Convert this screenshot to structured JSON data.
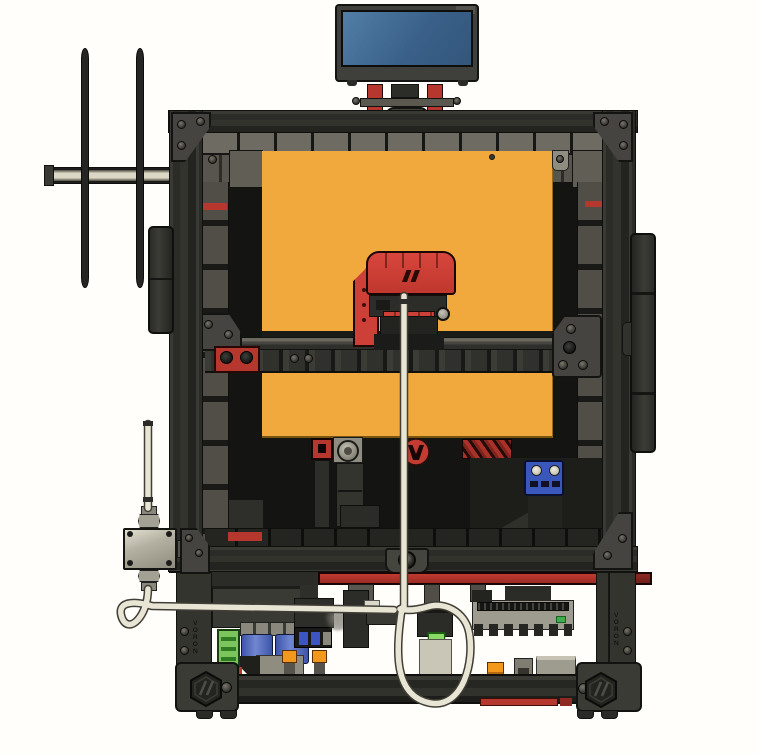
{
  "scene": {
    "title": "Voron-style 3D printer — CAD front view render",
    "background": "#fffefa"
  },
  "branding": {
    "left_rail_text": "VORON",
    "right_rail_text": "VORON"
  },
  "icons": {
    "hex_corner_logo": "voron-hex-logo",
    "round_chamber_logo": "voron-round-logo",
    "toolhead_logo": "voron-slash-logo"
  },
  "colors": {
    "bg": "#fffefa",
    "frame": "#31312d",
    "frame-light": "#454540",
    "frame-dark": "#131311",
    "panel": "#6e6c62",
    "panel-dark": "#57554d",
    "chamber": "#141412",
    "bed": "#f1a83c",
    "red": "#b5372e",
    "toolhead-red": "#cd4037",
    "display-blue": "#3a618a",
    "display-blue-light": "#527ea6",
    "tube": "#e9e5d4",
    "tube-edge": "#403e36",
    "green": "#7cc45c",
    "lever-green": "#8ada66",
    "cap-blue": "#5570c2",
    "orange": "#f2991d",
    "pcb": "#9e9c8f",
    "blue-block": "#3a57bb",
    "metal": "#c9c6b8",
    "spool": "#4a4a44"
  }
}
